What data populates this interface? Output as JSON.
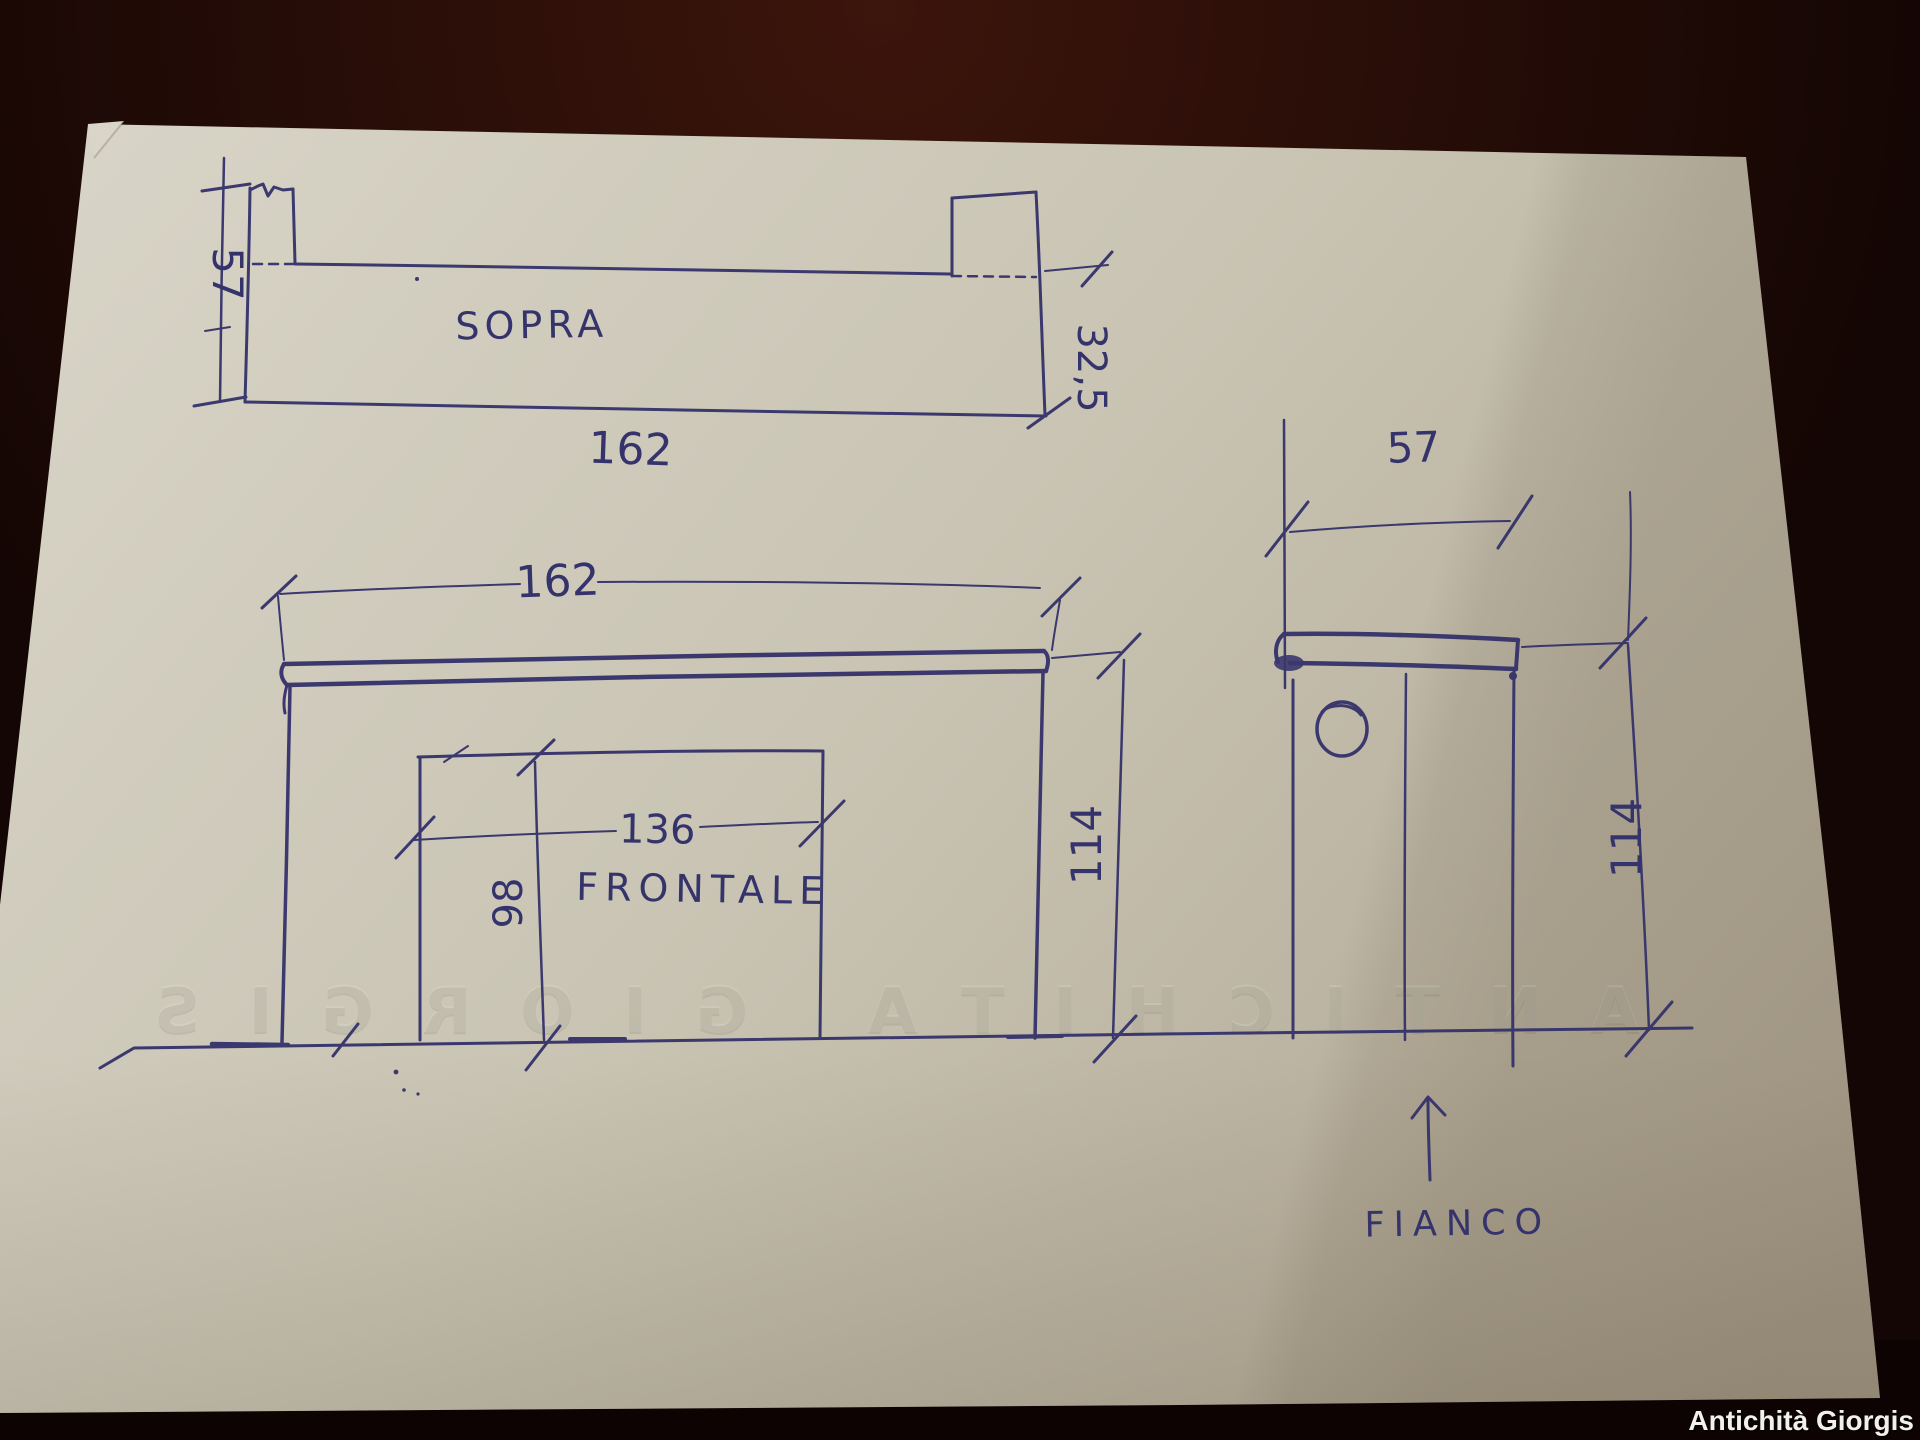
{
  "photo": {
    "credit": "Antichità Giorgis",
    "embossed_watermark": "ANTICHITA GIORGIS"
  },
  "drawing": {
    "top_view": {
      "label": "SOPRA",
      "depth_total": "57",
      "width": "162",
      "shelf_depth": "32,5"
    },
    "front_view": {
      "label": "FRONTALE",
      "width": "162",
      "opening_width": "136",
      "opening_height": "98",
      "total_height": "114"
    },
    "side_view": {
      "label": "FIANCO",
      "depth": "57",
      "total_height": "114"
    }
  },
  "colors": {
    "ink": "#35336b",
    "paper": "#c9c4b3",
    "table_dark": "#140604",
    "table_glow": "#38120b",
    "credit_text": "#f2f0ec"
  }
}
